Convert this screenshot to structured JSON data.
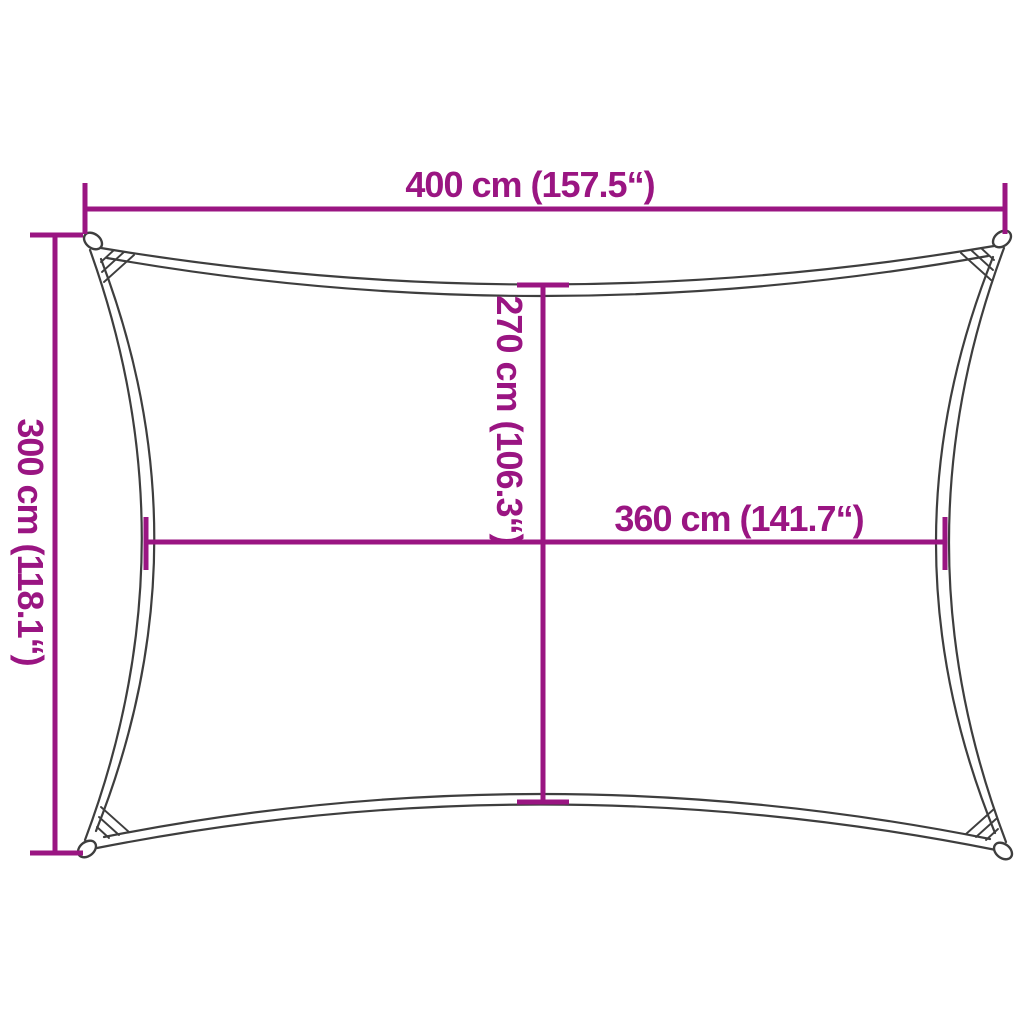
{
  "diagram": {
    "title": "shade-sail-dimension-diagram",
    "labels": {
      "outer_width": "400 cm (157.5“)",
      "outer_height": "300 cm (118.1“)",
      "inner_height": "270 cm (106.3“)",
      "inner_width": "360 cm (141.7“)"
    }
  },
  "colors": {
    "dimension": "#9A1582",
    "outline": "#3E3E3E",
    "background": "#FFFFFF"
  }
}
